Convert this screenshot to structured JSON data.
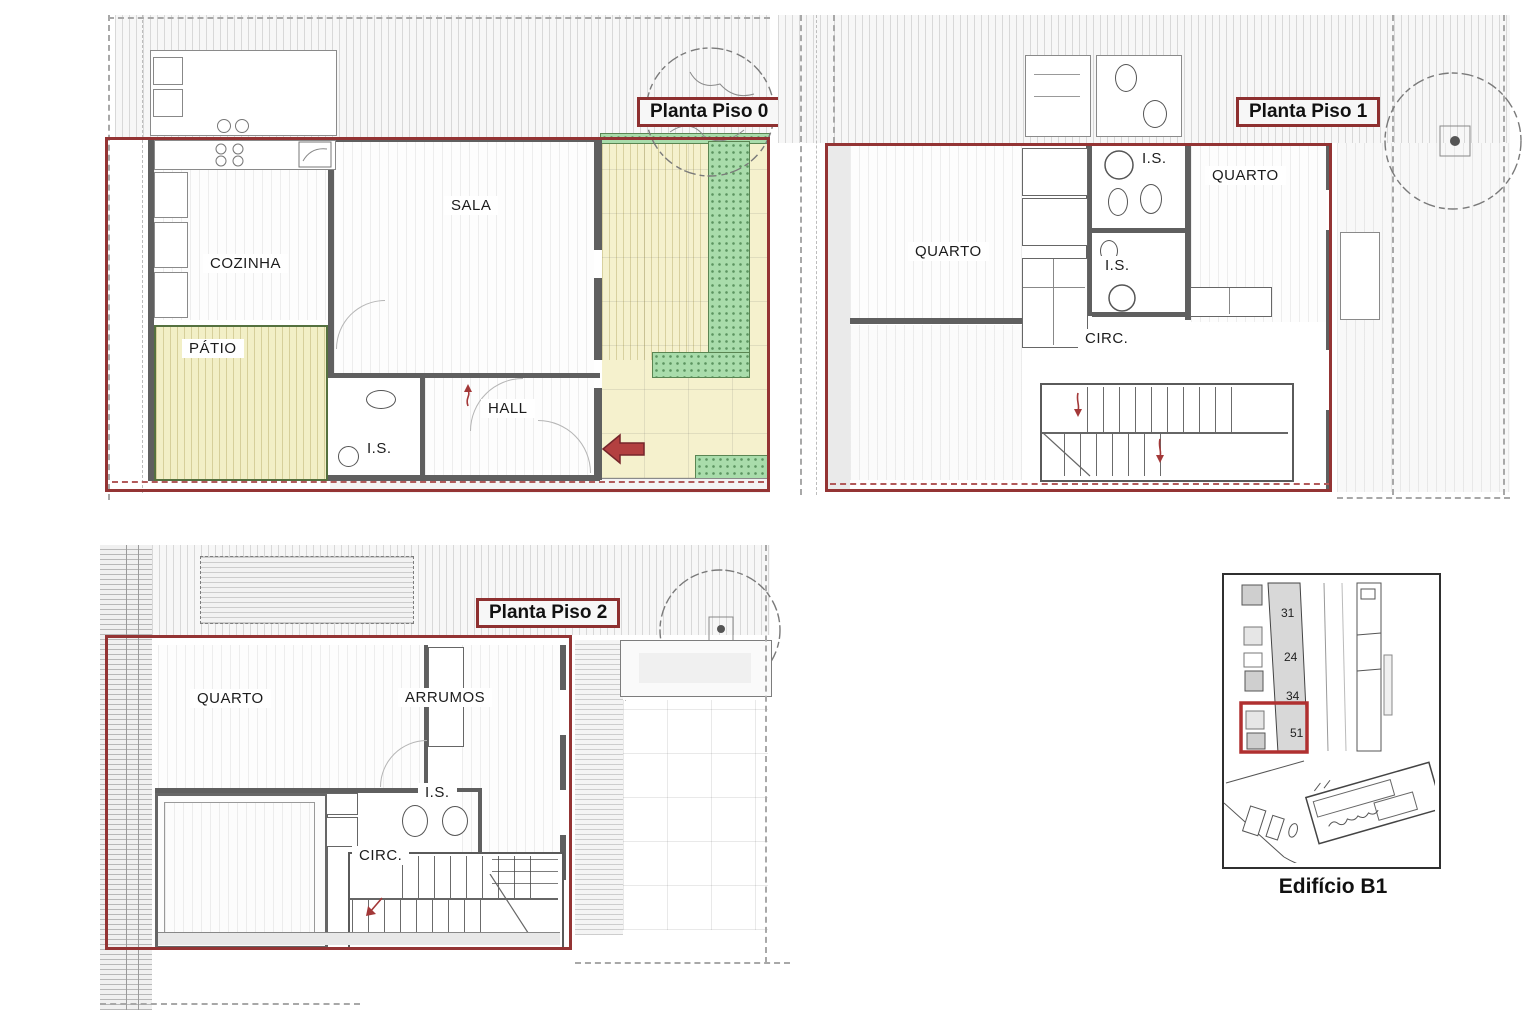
{
  "colors": {
    "boundary_red": "#943434",
    "label_border_red": "#8e3030",
    "arrow_red": "#b34040",
    "patio_yellow": "#f2efc6",
    "garden_yellow": "#f5f1cd",
    "green_area": "#a9dcab",
    "patio_border_green": "#55713f",
    "wall_gray": "#5f5f5f"
  },
  "plans": {
    "piso0": {
      "title": "Planta Piso 0",
      "rooms": [
        {
          "label": "SALA"
        },
        {
          "label": "COZINHA"
        },
        {
          "label": "PÁTIO"
        },
        {
          "label": "HALL"
        },
        {
          "label": "I.S."
        }
      ]
    },
    "piso1": {
      "title": "Planta Piso 1",
      "rooms": [
        {
          "label": "QUARTO"
        },
        {
          "label": "I.S."
        },
        {
          "label": "QUARTO"
        },
        {
          "label": "I.S."
        },
        {
          "label": "CIRC."
        }
      ]
    },
    "piso2": {
      "title": "Planta Piso 2",
      "rooms": [
        {
          "label": "QUARTO"
        },
        {
          "label": "ARRUMOS"
        },
        {
          "label": "I.S."
        },
        {
          "label": "CIRC."
        }
      ]
    }
  },
  "key_plan": {
    "caption": "Edifício B1",
    "unit_numbers": [
      "31",
      "24",
      "34",
      "51"
    ]
  }
}
